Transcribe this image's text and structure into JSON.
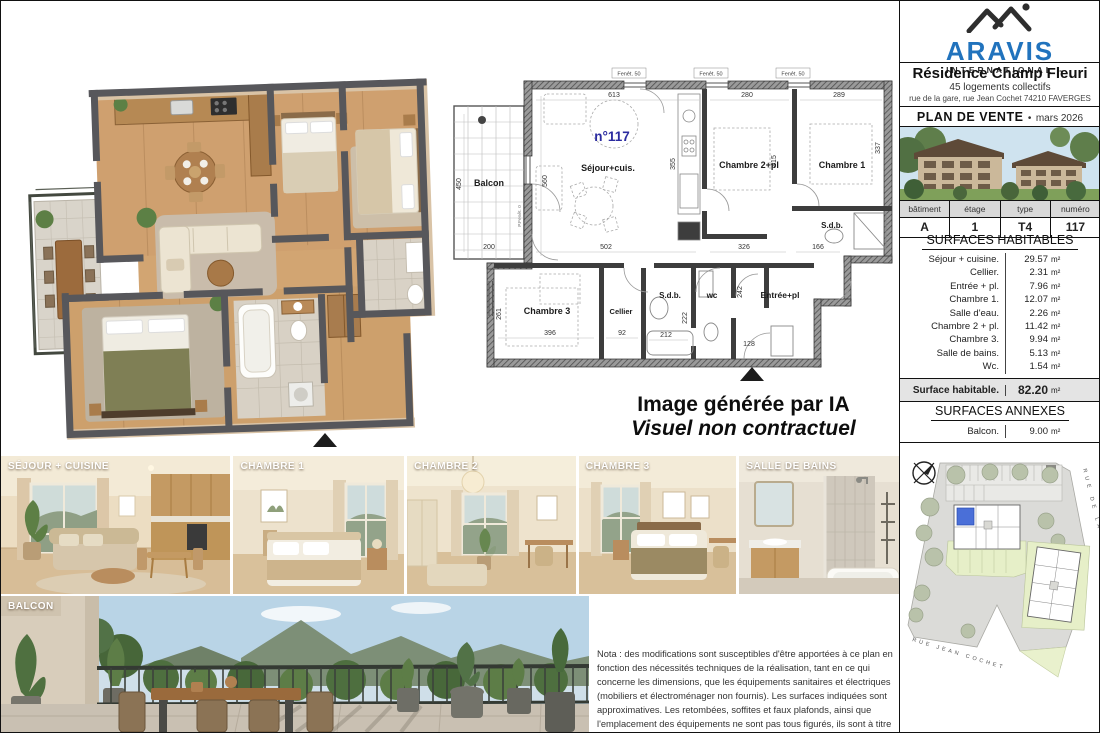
{
  "ai_disclaimer": {
    "line1": "Image générée par IA",
    "line2": "Visuel non contractuel"
  },
  "header": {
    "brand_name": "ARAVIS",
    "brand_tagline": "- INTERNATIONAL -",
    "residence_name": "Résidence Champ Fleuri",
    "residence_subtitle": "45 logements collectifs",
    "residence_address": "rue de la gare, rue Jean Cochet 74210 FAVERGES",
    "document_type": "PLAN DE VENTE",
    "document_separator": "•",
    "document_date": "mars 2026"
  },
  "unit_info": {
    "headers": [
      "bâtiment",
      "étage",
      "type",
      "numéro"
    ],
    "values": [
      "A",
      "1",
      "T4",
      "117"
    ]
  },
  "surfaces_habitables": {
    "title": "SURFACES HABITABLES",
    "unit": "m²",
    "rows": [
      {
        "label": "Séjour + cuisine.",
        "value": "29.57"
      },
      {
        "label": "Cellier.",
        "value": "2.31"
      },
      {
        "label": "Entrée + pl.",
        "value": "7.96"
      },
      {
        "label": "Chambre 1.",
        "value": "12.07"
      },
      {
        "label": "Salle d'eau.",
        "value": "2.26"
      },
      {
        "label": "Chambre 2 + pl.",
        "value": "11.42"
      },
      {
        "label": "Chambre 3.",
        "value": "9.94"
      },
      {
        "label": "Salle de bains.",
        "value": "5.13"
      },
      {
        "label": "Wc.",
        "value": "1.54"
      }
    ],
    "total_label": "Surface habitable.",
    "total_value": "82.20"
  },
  "surfaces_annexes": {
    "title": "SURFACES ANNEXES",
    "rows": [
      {
        "label": "Balcon.",
        "value": "9.00"
      }
    ]
  },
  "site_plan": {
    "street_right": "RUE DE LA GARE",
    "street_bottom": "RUE JEAN COCHET"
  },
  "plan2d": {
    "unit_number": "n°117",
    "window_label": "Fenêt. 50",
    "porte_label": "P.Fenêt. 0",
    "rooms": {
      "balcon": "Balcon",
      "sejour": "Séjour+cuis.",
      "chambre2": "Chambre 2+pl",
      "chambre1": "Chambre 1",
      "sdb_top": "S.d.b.",
      "chambre3": "Chambre 3",
      "cellier": "Cellier",
      "sdb_bottom": "S.d.b.",
      "wc": "wc",
      "entree": "Entrée+pl"
    },
    "dims": {
      "d613": "613",
      "d280": "280",
      "d289": "289",
      "d560": "560",
      "d450": "450",
      "d200": "200",
      "d355": "355",
      "d415": "415",
      "d337": "337",
      "d502": "502",
      "d326": "326",
      "d166": "166",
      "d396": "396",
      "d92": "92",
      "d212": "212",
      "d222": "222",
      "d242": "242",
      "d128": "128",
      "d261": "261"
    }
  },
  "photo_labels": {
    "p1": "SÉJOUR + CUISINE",
    "p2": "CHAMBRE 1",
    "p3": "CHAMBRE 2",
    "p4": "CHAMBRE 3",
    "p5": "SALLE DE BAINS",
    "balcony": "BALCON"
  },
  "nota_text": "Nota : des modifications sont susceptibles d'être apportées à ce plan en fonction des nécessités techniques de la réalisation, tant en ce qui concerne les dimensions, que les équipements sanitaires et électriques (mobiliers et électroménager non fournis). Les surfaces indiquées sont approximatives. Les retombées, soffites et faux plafonds, ainsi que l'emplacement des équipements ne sont pas tous figurés, ils sont à titre indicatif. Les surfaces des jardins ne sont données qu'à titre indicatif. Les pentes ne sont pas représentées en fonction du terrain naturel."
}
